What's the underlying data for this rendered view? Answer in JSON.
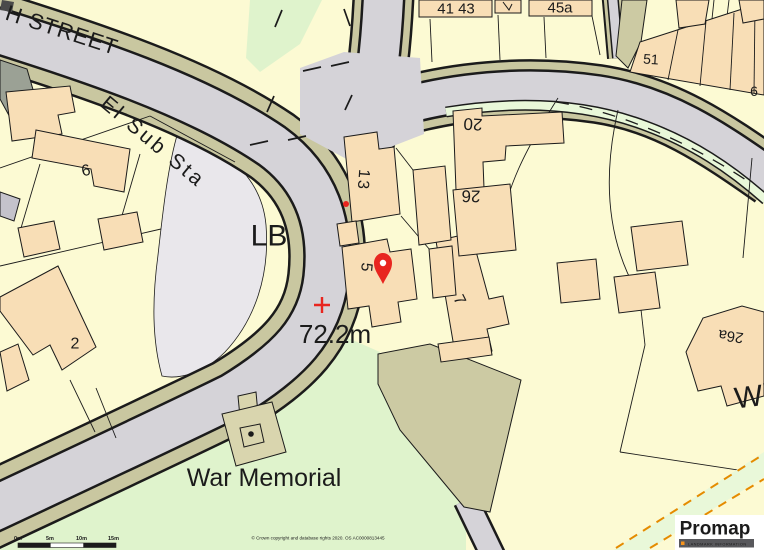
{
  "map": {
    "labels": {
      "street": "H STREET",
      "el_sub_sta": "El Sub Sta",
      "lb": "LB",
      "spot_height": "72.2m",
      "war_memorial": "War Memorial",
      "street_right_partial": "Wi",
      "building_6": "6",
      "building_2": "2",
      "building_13": "13",
      "building_5": "5",
      "building_7": "7",
      "building_20": "20",
      "building_26": "26",
      "building_26a": "26a",
      "building_41_43": "41 43",
      "building_45a": "45a",
      "building_51": "51",
      "building_6_right": "6"
    },
    "marker": {
      "type": "location-pin"
    },
    "scale_bar": {
      "ticks": [
        "0m",
        "5m",
        "10m",
        "15m"
      ]
    },
    "copyright": "© Crown copyright and database rights 2020. OS AC0000813445",
    "logo": {
      "name": "Promap",
      "tagline": "LANDMARK INFORMATION"
    },
    "colors": {
      "plot": "#FCFAD3",
      "road": "#D5D3D8",
      "verge": "#C9C7A0",
      "wedge": "#CCCAA3",
      "plinth": "#D9D5AE",
      "island": "#E9E7EB",
      "green": "#DFF3CC",
      "green_light": "#E9F8D9",
      "building": "#F8DEB6",
      "building_gray": "#9BA195",
      "building_gray2": "#C4C2CB",
      "line": "#1b1b1b",
      "red": "#E8251F",
      "orange": "#E58B00",
      "logo_dark": "#3F3F42",
      "logo_bar": "#58585C",
      "logo_orange": "#F7941D",
      "logo_bg": "#FFFFFF"
    }
  }
}
